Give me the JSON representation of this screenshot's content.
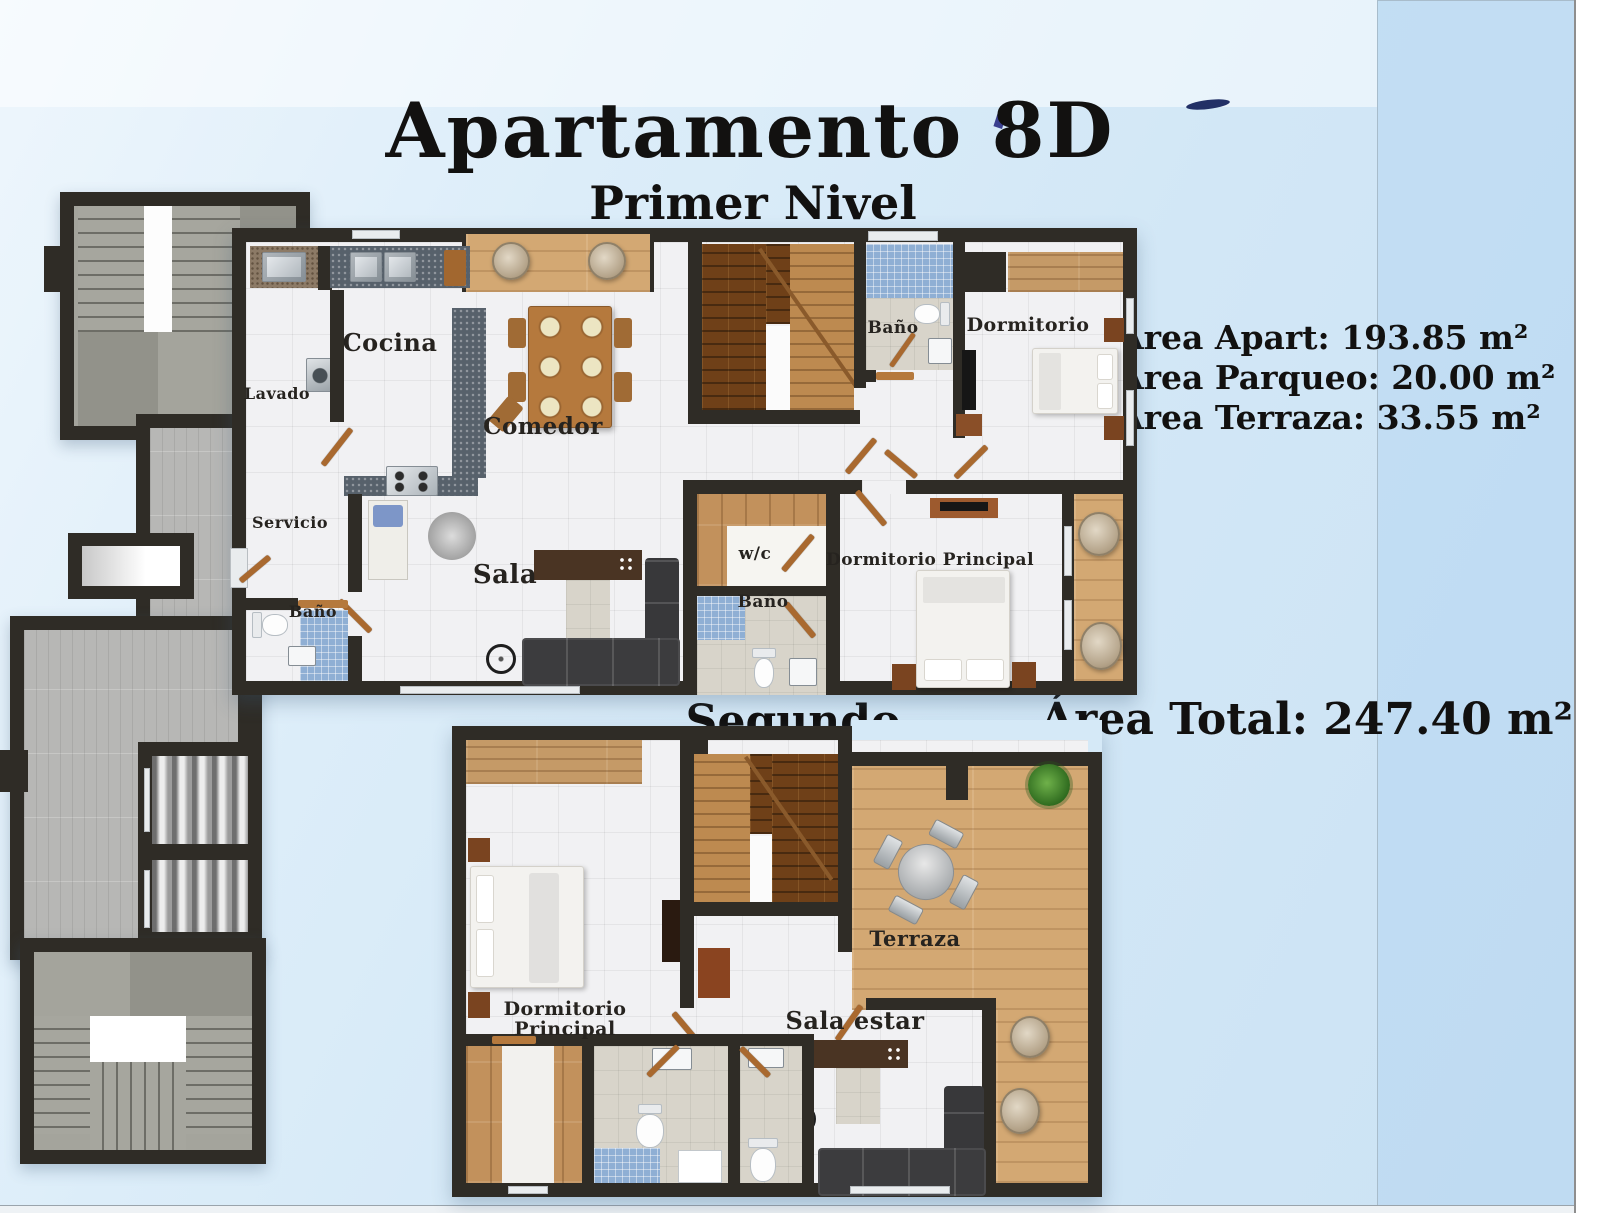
{
  "title": "Apartamento  8D",
  "levels": {
    "level1": {
      "heading": "Primer Nivel",
      "rooms": {
        "cocina": "Cocina",
        "lavado": "Lavado",
        "comedor": "Comedor",
        "servicio": "Servicio",
        "bano_servicio": "Baño",
        "sala": "Sala",
        "wc": "w/c",
        "bano": "Baño",
        "bano_principal": "Baño",
        "dormitorio": "Dormitorio",
        "dormitorio_principal": "Dormitorio Principal"
      }
    },
    "level2": {
      "heading": "Segundo Nivel",
      "rooms": {
        "dormitorio_principal": "Dormitorio Principal",
        "sala_estar": "Sala estar",
        "terraza": "Terraza"
      }
    }
  },
  "areas": {
    "apart": "Área Apart: 193.85 m²",
    "parqueo": "Área Parqueo: 20.00 m²",
    "terraza": "Área Terraza: 33.55 m²",
    "total": "Área Total: 247.40 m²"
  },
  "colors": {
    "background": "#d2e7f6",
    "wall": "#2f2c26",
    "wood": "#c2915c",
    "terrace_wood": "#d3a873",
    "mosaic_blue": "#8fafd4",
    "text": "#121110"
  }
}
